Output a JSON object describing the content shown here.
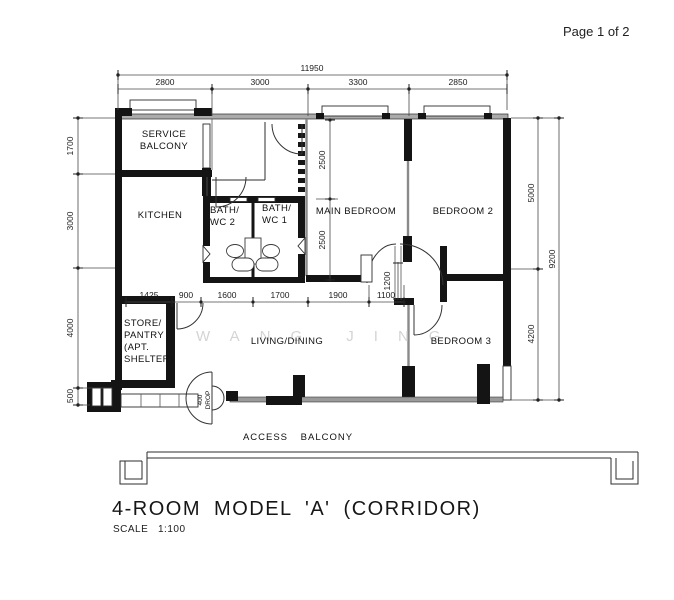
{
  "page": {
    "indicator": "Page 1 of 2"
  },
  "drawing_title": {
    "name": "4-ROOM MODEL 'A' (CORRIDOR)",
    "scale_label": "SCALE",
    "scale_value": "1:100"
  },
  "watermark": "WANG JING",
  "rooms": {
    "service_balcony_line1": "SERVICE",
    "service_balcony_line2": "BALCONY",
    "kitchen": "KITCHEN",
    "bath_wc2_line1": "BATH/",
    "bath_wc2_line2": "WC 2",
    "bath_wc1_line1": "BATH/",
    "bath_wc1_line2": "WC 1",
    "main_bedroom": "MAIN BEDROOM",
    "bedroom2": "BEDROOM 2",
    "bedroom3": "BEDROOM 3",
    "living_dining": "LIVING/DINING",
    "store_line1": "STORE/",
    "store_line2": "PANTRY",
    "store_line3": "(APT.",
    "store_line4": "SHELTER)",
    "access_balcony": "ACCESS BALCONY"
  },
  "dimensions": {
    "top_overall": "11950",
    "top_segments": [
      "2800",
      "3000",
      "3300",
      "2850"
    ],
    "left_segments": [
      "1700",
      "3000",
      "4000",
      "500"
    ],
    "right_segments": [
      "5000",
      "4200"
    ],
    "right_overall": "9200",
    "mid_segments": [
      "1425",
      "900",
      "1600",
      "1700",
      "1900",
      "1100"
    ],
    "main_bedroom_depth_upper": "2500",
    "main_bedroom_depth_lower": "2500",
    "door_width": "1200"
  },
  "annotations": {
    "drop_line1": "400",
    "drop_line2": "DROP"
  }
}
